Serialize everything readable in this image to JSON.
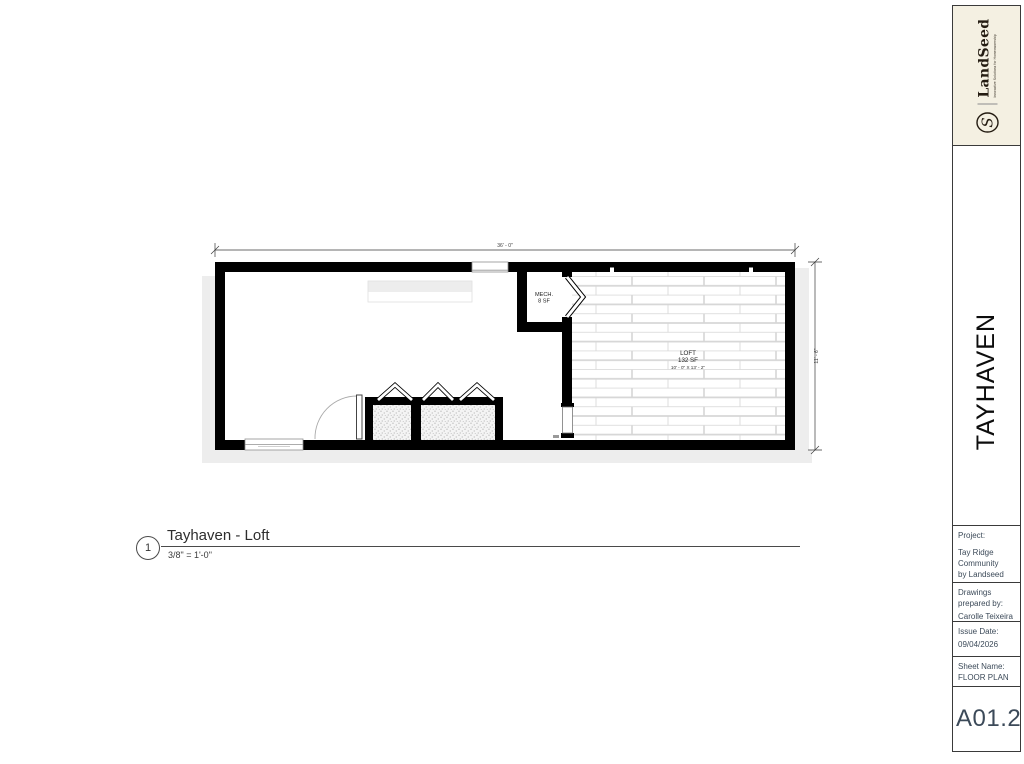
{
  "sheet": {
    "title_block": {
      "logo": {
        "brand": "LandSeed",
        "tagline": "Innovative Solutions for Homeownership",
        "monogram": "S"
      },
      "project_name_vertical": "TAYHAVEN",
      "project": {
        "label": "Project:",
        "lines": [
          "Tay Ridge",
          "Community",
          "by Landseed"
        ]
      },
      "prepared": {
        "label_lines": [
          "Drawings",
          "prepared by:"
        ],
        "name": "Carolle Teixeira"
      },
      "issue": {
        "label": "Issue Date:",
        "date": "09/04/2026"
      },
      "sheet_name": {
        "label": "Sheet Name:",
        "value": "FLOOR PLAN"
      },
      "sheet_number": "A01.2"
    },
    "view_title": {
      "detail_number": "1",
      "title": "Tayhaven - Loft",
      "scale": "3/8\" = 1'-0\""
    },
    "plan": {
      "rooms": [
        {
          "name": "MECH.",
          "area": "8 SF"
        },
        {
          "name": "LOFT",
          "area": "132 SF",
          "dims": "10' - 0\" X 13' - 2\""
        }
      ],
      "dimensions": {
        "width": "36' - 0\"",
        "height": "11' - 6\""
      }
    }
  },
  "colors": {
    "wall": "#000000",
    "plank_line": "#d6d6d6",
    "shadow": "#ededed",
    "titleblock_text": "#3c4a59",
    "logo_background": "#f4f0e2",
    "brand_text": "#241c12"
  }
}
